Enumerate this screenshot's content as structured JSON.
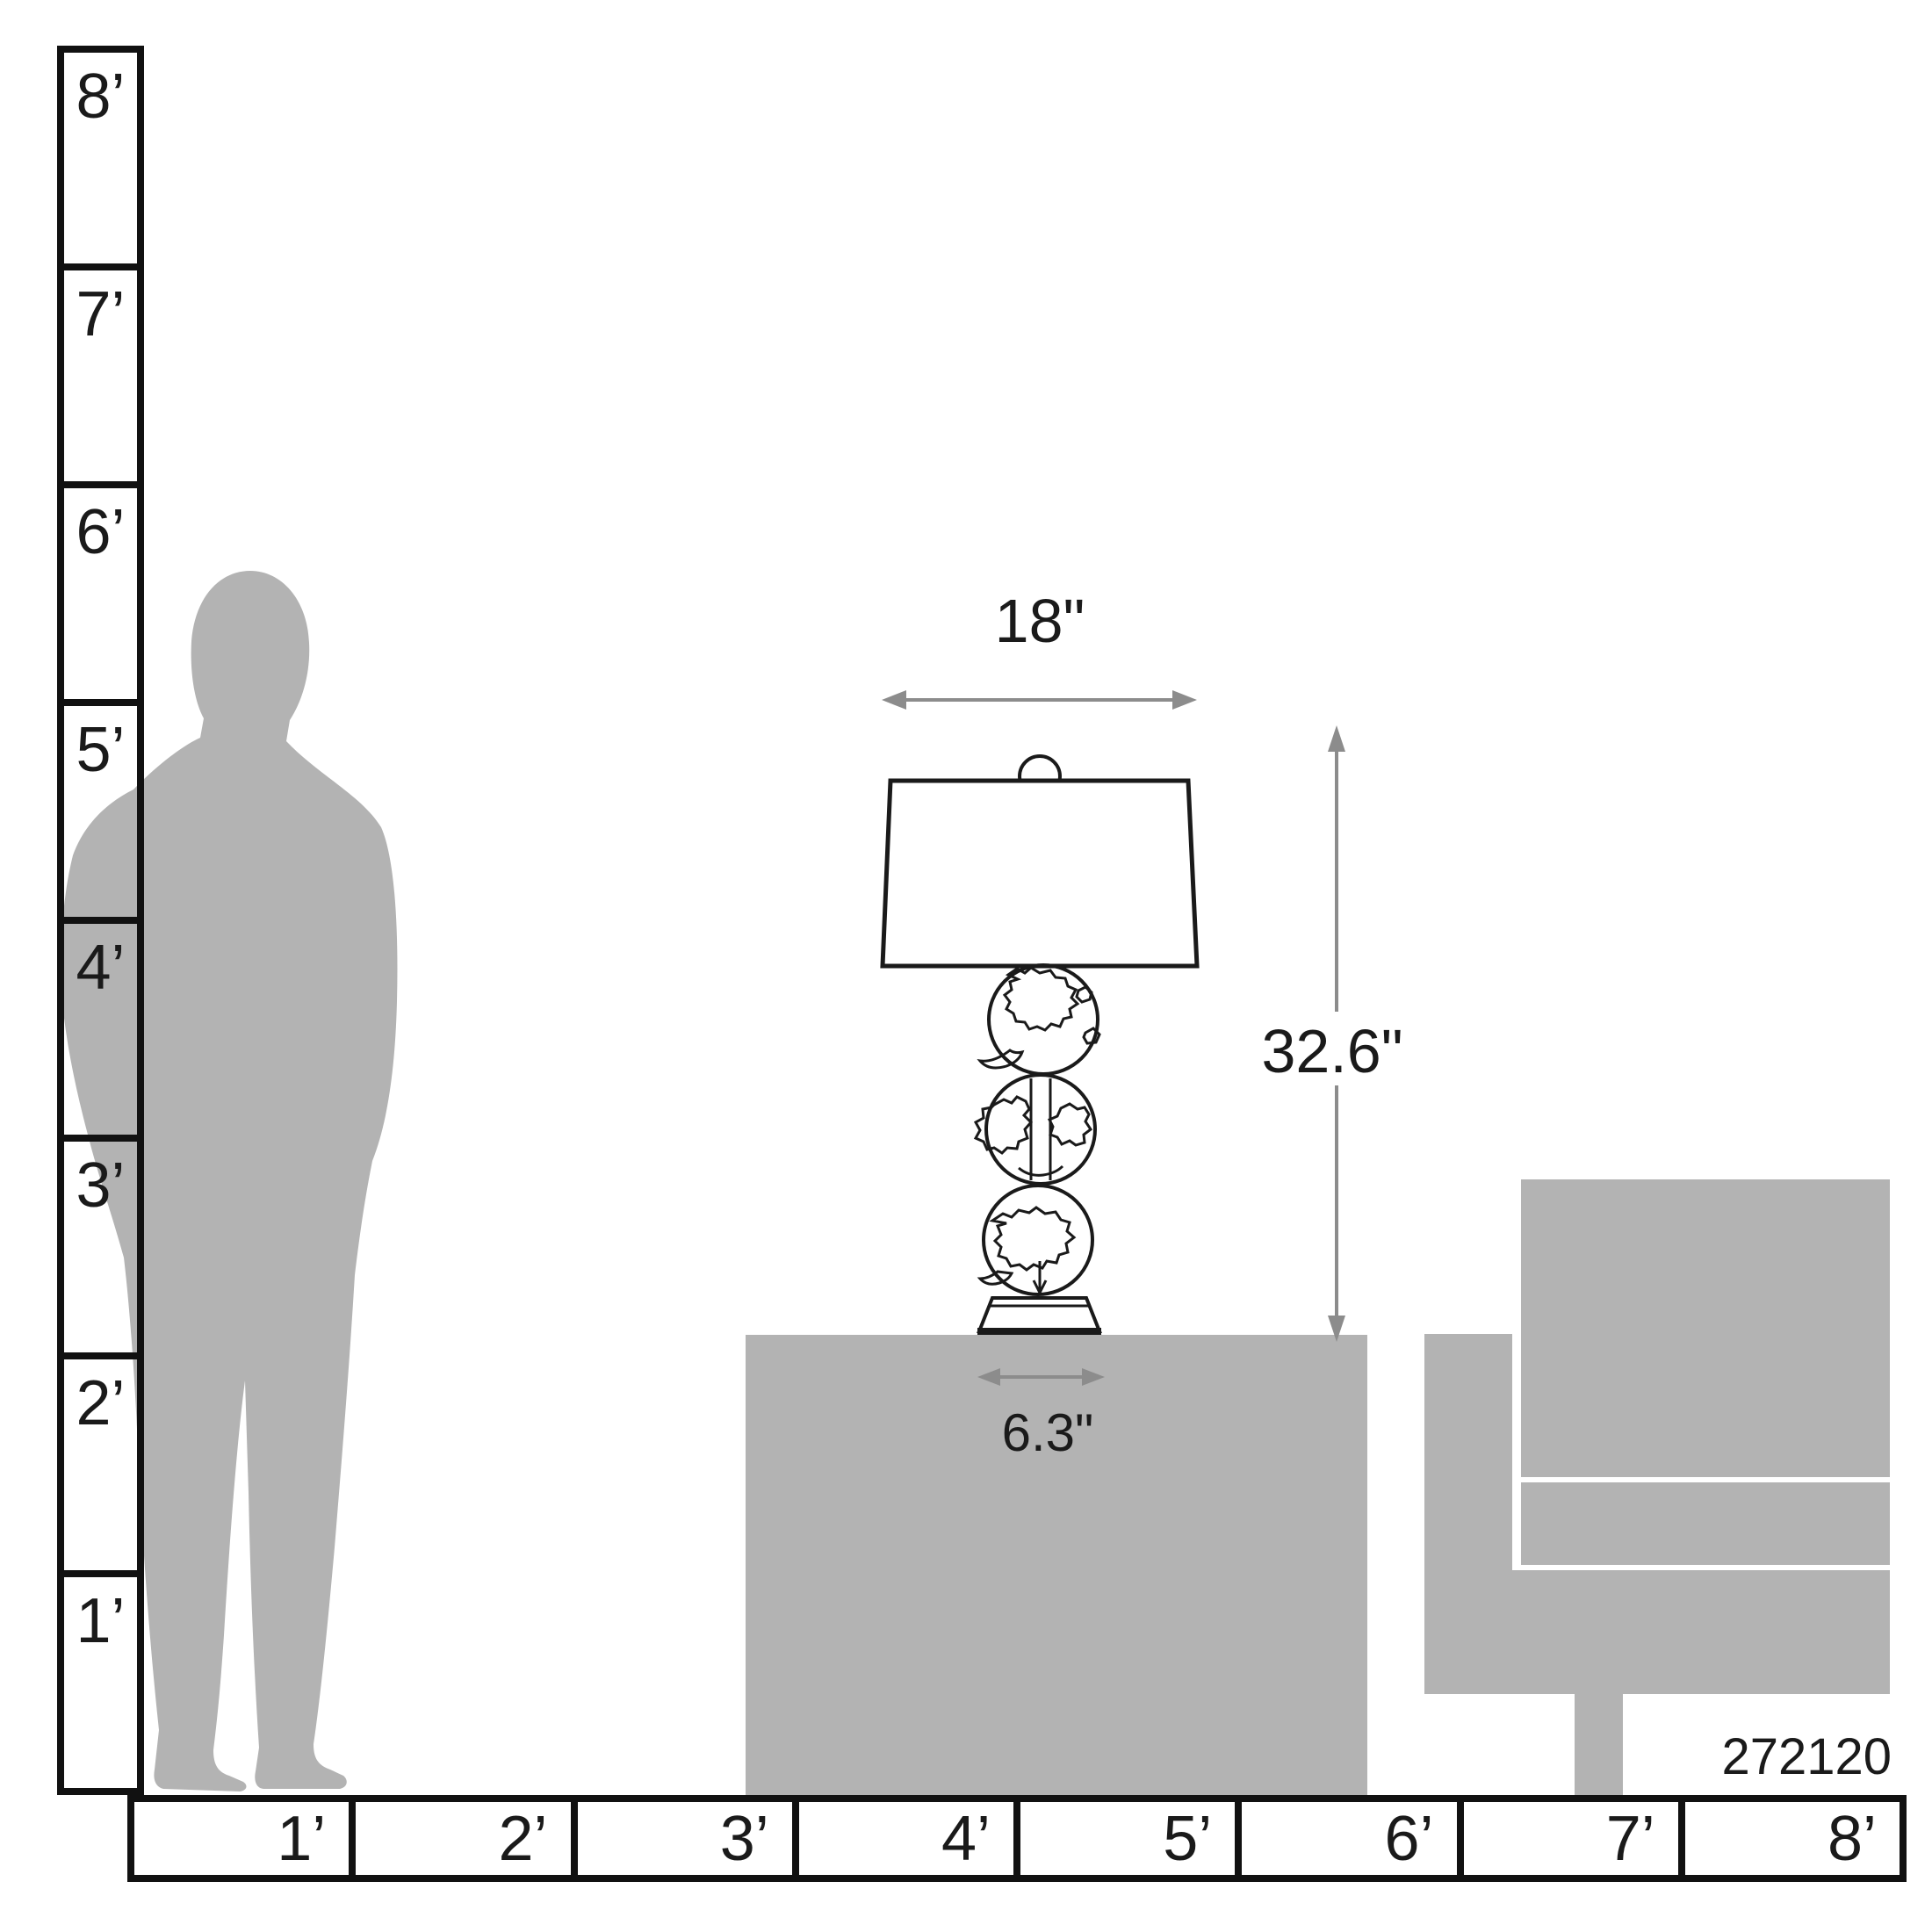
{
  "diagram": {
    "product_code": "272120",
    "dimensions": {
      "shade_width": "18\"",
      "lamp_height": "32.6\"",
      "base_width": "6.3\""
    },
    "vertical_ruler": {
      "labels": [
        "8’",
        "7’",
        "6’",
        "5’",
        "4’",
        "3’",
        "2’",
        "1’"
      ]
    },
    "horizontal_ruler": {
      "labels": [
        "1’",
        "2’",
        "3’",
        "4’",
        "5’",
        "6’",
        "7’",
        "8’"
      ]
    },
    "colors": {
      "silhouette_gray": "#b3b3b3",
      "dimension_arrow_gray": "#8c8c8c",
      "line_black": "#1a1a1a"
    }
  }
}
